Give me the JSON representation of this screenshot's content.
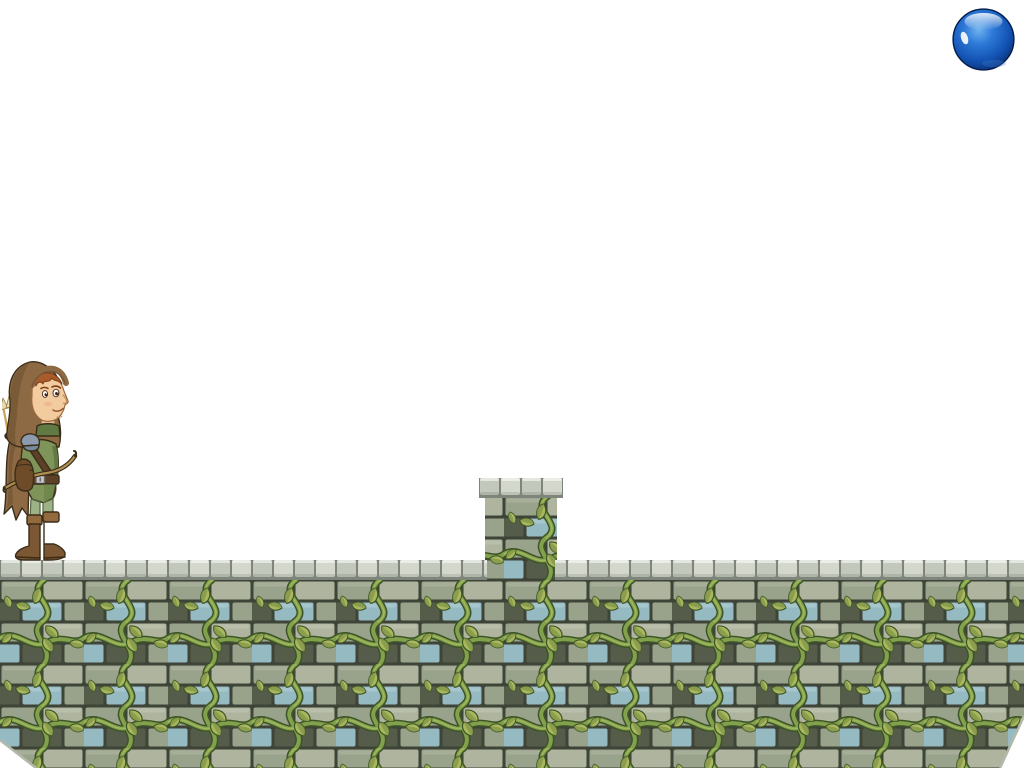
{
  "app": "side-scrolling platformer game scene",
  "colors": {
    "bg": "#ffffff",
    "mortar": "#3e4437",
    "brick": "#99a28a",
    "brickL": "#aeb49d",
    "brickB": "#95bac2",
    "brickD": "#555c49",
    "vine": "#83a04c",
    "vineDark": "#3c5426",
    "vineLight": "#aabf63",
    "leaf": "#a9b85f",
    "leafDark": "#7f9347",
    "cap": "#c3c8bc",
    "capLight": "#d3d7cc",
    "capShadow": "#7e857a",
    "ballLight": "#6fb4ee",
    "ballMid": "#2e7ad8",
    "ballDeep": "#1353b4",
    "ballDark": "#07245c",
    "hood": "#8d6a43",
    "hoodDark": "#6b4e30",
    "skin": "#f2cb9f",
    "hair": "#a95b2b",
    "tunic": "#7e9459",
    "tunicDark": "#617a44",
    "pants": "#9eb287",
    "boots": "#7b5733",
    "bootsLight": "#936a3e",
    "leather": "#5d4026",
    "bracer": "#6e4b29",
    "pauldron": "#8c9cae",
    "arrowShaft": "#c9a55b",
    "fletching": "#e8dcae",
    "buckle": "#c9c9c9",
    "outline": "#3a2d1a"
  },
  "objects": {
    "ball": {
      "label": "glossy blue ball",
      "rect": {
        "x": 952,
        "y": 8,
        "w": 63,
        "h": 63
      }
    },
    "player": {
      "label": "hooded archer character",
      "facing": "right",
      "rect": {
        "x": 2,
        "y": 358,
        "w": 78,
        "h": 205
      }
    },
    "pillar": {
      "label": "raised stone block with cap and vines",
      "cap_rect": {
        "x": 479,
        "y": 478,
        "w": 84,
        "h": 20
      },
      "body_rect": {
        "x": 485,
        "y": 498,
        "w": 72,
        "h": 84
      }
    },
    "platform": {
      "label": "vine-covered stone brick wall platform",
      "body_rect": {
        "x": 0,
        "y": 580,
        "w": 1024,
        "h": 188
      },
      "cap_left_rect": {
        "x": 0,
        "y": 560,
        "w": 487,
        "h": 20
      },
      "cap_right_rect": {
        "x": 555,
        "y": 560,
        "w": 469,
        "h": 20
      },
      "cut_left_points": "0,740 36,768 0,768",
      "cut_right_points": "1024,716 1024,768 1000,768",
      "edge_left_points": "0,740 36,768",
      "edge_right_points": "1024,716 1000,768"
    }
  }
}
